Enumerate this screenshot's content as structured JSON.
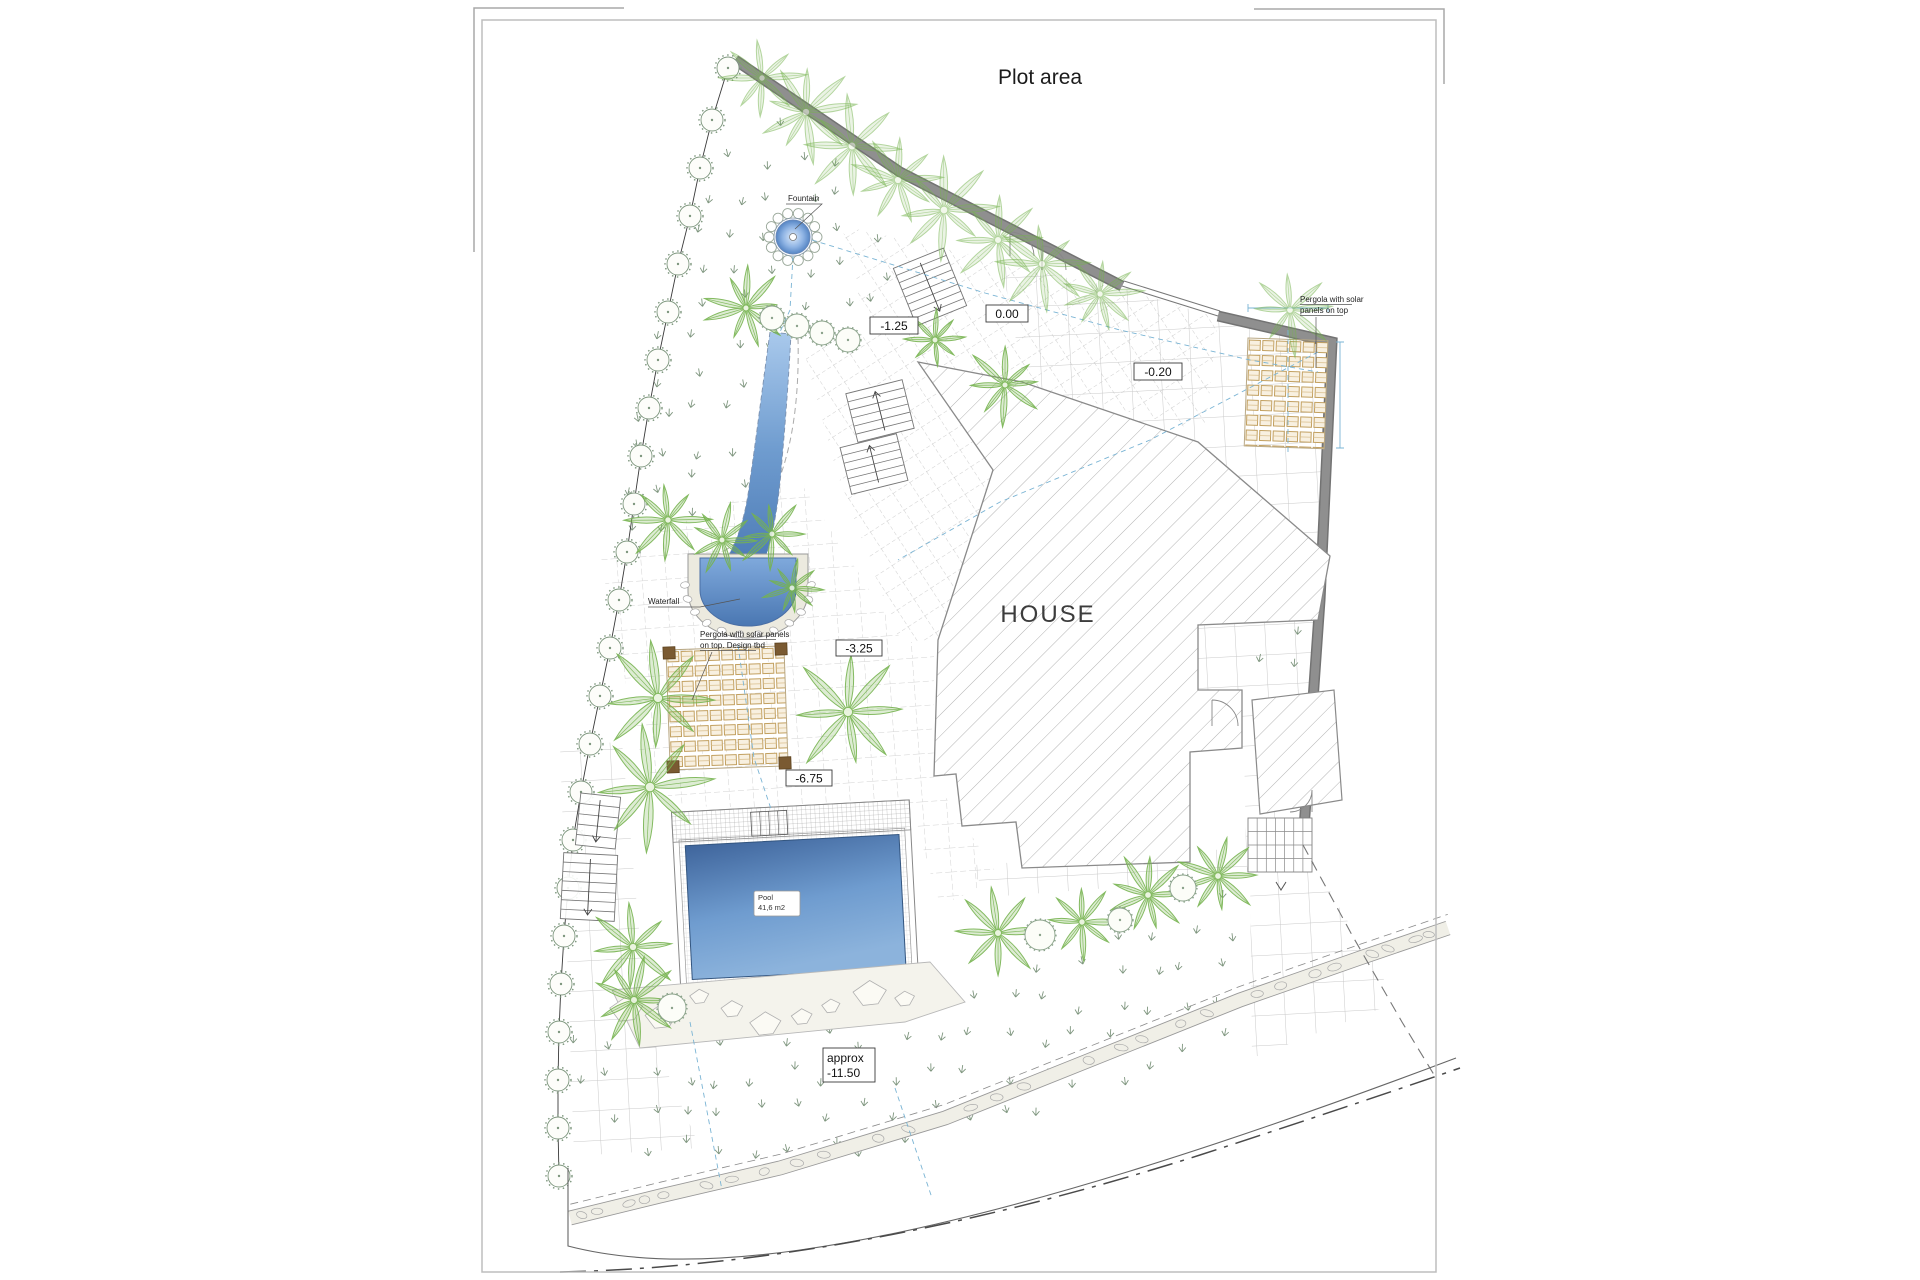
{
  "labels": {
    "title": "Plot area",
    "house": "HOUSE",
    "fountain": "Fountain",
    "waterfall": "Waterfall",
    "pergola_left_line1": "Pergola with solar panels",
    "pergola_left_line2": "on top. Design tbd",
    "pergola_right_line1": "Pergola with solar",
    "pergola_right_line2": "panels on top",
    "pool_line1": "Pool",
    "pool_line2": "41,6 m2",
    "level_upper_court": "-1.25",
    "level_entry": "0.00",
    "level_terrace": "-0.20",
    "level_garden_upper": "-3.25",
    "level_garden_mid": "-6.75",
    "level_lower_line1": "approx",
    "level_lower_line2": "-11.50"
  },
  "colors": {
    "wall": "#8f8f8f",
    "wall_edge": "#737373",
    "palm": "#76b34f",
    "water_light": "#a9c9ec",
    "water_dark": "#4c7ab5",
    "panel": "#c2a060",
    "hatch": "#b3b3b3",
    "grass": "#7f967f",
    "utility": "#7ab4d4",
    "hedge": "#7d967d",
    "stone": "#f0efe7"
  }
}
